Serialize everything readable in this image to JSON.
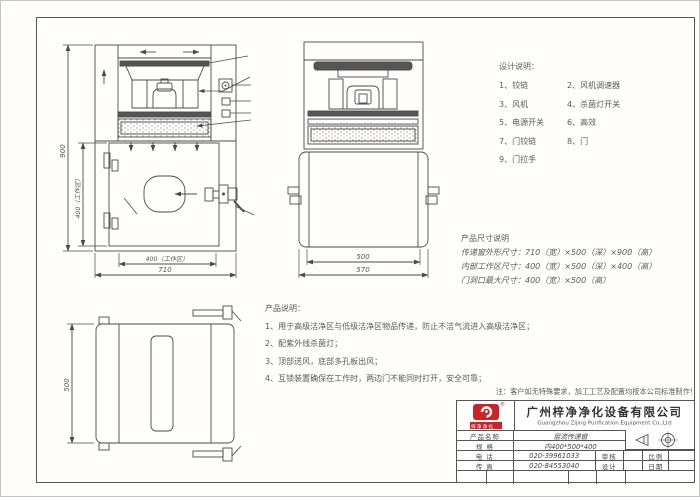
{
  "design_notes": {
    "title": "设计说明：",
    "items": [
      "1、铰链",
      "2、风机调速器",
      "3、风机",
      "4、杀菌灯开关",
      "5、电源开关",
      "6、高效",
      "7、门铰链",
      "8、门",
      "9、门拉手"
    ]
  },
  "size_spec": {
    "title": "产品尺寸说明",
    "lines": [
      "传递窗外形尺寸：710（宽）×500（深）×900（高）",
      "内部工作区尺寸：400（宽）×500（深）×400（高）",
      "门洞口最大尺寸：400（宽）×500（高）"
    ]
  },
  "product_notes": {
    "title": "产品说明：",
    "lines": [
      "1、用于高级洁净区与低级洁净区物品传递，防止不洁气流进入高级洁净区；",
      "2、配紫外线杀菌灯；",
      "3、顶部送风，底部多孔板出风；",
      "4、互锁装置确保在工作时，两边门不能同时打开，安全可靠；"
    ],
    "remark": "注：客户如无特殊要求，加工工艺及配置均按本公司标准制作！"
  },
  "dimensions": {
    "front_height": "900",
    "front_work_height": "400（工作区）",
    "front_work_width": "400（工作区）",
    "front_width": "710",
    "side_inner": "500",
    "side_outer": "570",
    "top_depth": "500"
  },
  "title_block": {
    "company_cn": "广州梓净净化设备有限公司",
    "company_en": "Guangzhou Zijing Purification Equipment Co.,Ltd",
    "logo_banner": "梓净净化",
    "reg_mark": "®",
    "product_label": "产品名称",
    "product_value": "层流传递窗",
    "spec_label": "规  格",
    "spec_value": "内400*500*400",
    "tel_label": "电  话",
    "tel_value": "020-39961033",
    "fax_label": "传  真",
    "fax_value": "020-84553040",
    "check_label": "审核",
    "design_label": "设计",
    "scale_label": "比例",
    "date_label": "日期"
  },
  "colors": {
    "line": "#4a4a4a",
    "logo_red": "#cc2327",
    "text": "#5a5a5a"
  }
}
